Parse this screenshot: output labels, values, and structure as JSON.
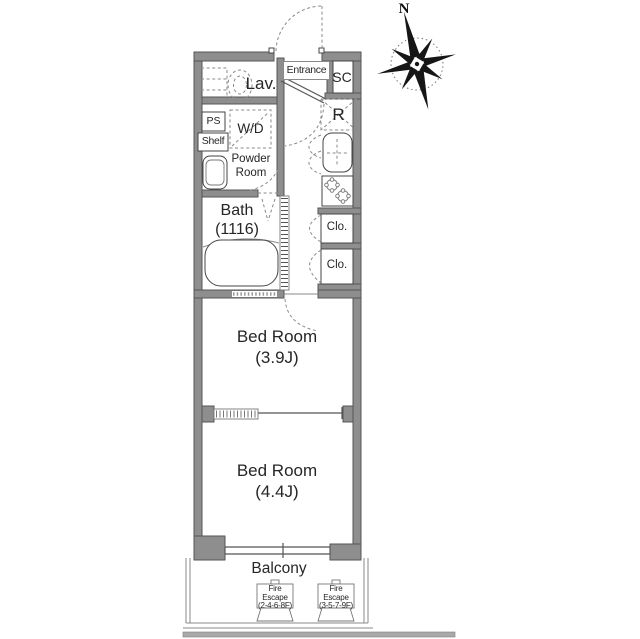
{
  "compass": {
    "north_label": "N"
  },
  "rooms": {
    "entrance": "Entrance",
    "lavatory": "Lav.",
    "shoe_closet": "SC",
    "refrigerator_space": "R",
    "pipe_shaft": "PS",
    "shelf": "Shelf",
    "washer_dryer": "W/D",
    "powder_room": "Powder\nRoom",
    "bath": "Bath\n(1116)",
    "closet_upper": "Clo.",
    "closet_lower": "Clo.",
    "bedroom_upper": "Bed Room\n(3.9J)",
    "bedroom_lower": "Bed Room\n(4.4J)",
    "balcony": "Balcony"
  },
  "fire_escapes": [
    {
      "label": "Fire\nEscape\n(2-4-6-8F)"
    },
    {
      "label": "Fire\nEscape\n(3-5-7-9F)"
    }
  ],
  "colors": {
    "wall": "#8e8e8e",
    "wall_outline": "#565656",
    "line_dark": "#444444",
    "line_mid": "#8a8a8a",
    "text": "#262626",
    "ground": "#a9a9a9"
  }
}
